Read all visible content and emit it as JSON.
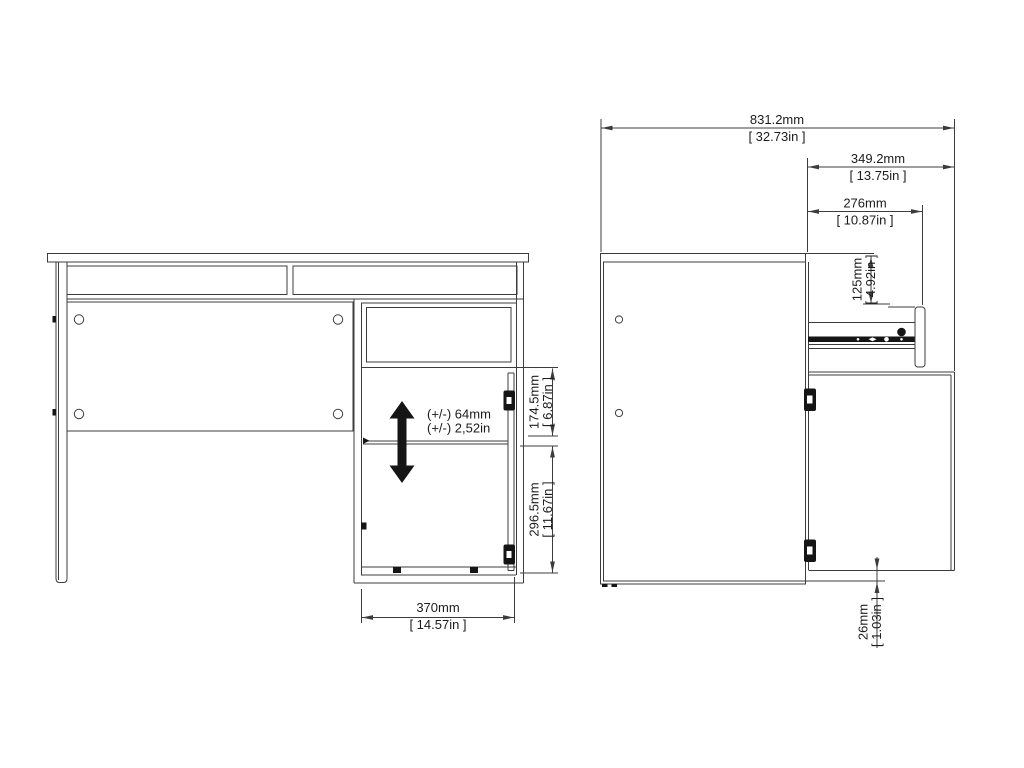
{
  "colors": {
    "background": "#ffffff",
    "line": "#3c3c3c",
    "text": "#1c1c1c",
    "solid_black": "#151515"
  },
  "dimensions": {
    "depth_total": {
      "mm": "831.2mm",
      "inch": "[ 32.73in ]"
    },
    "door_open_depth": {
      "mm": "349.2mm",
      "inch": "[ 13.75in ]"
    },
    "drawer_open_depth": {
      "mm": "276mm",
      "inch": "[ 10.87in ]"
    },
    "drawer_front_height": {
      "mm": "125mm",
      "inch": "[ 4.92in ]"
    },
    "upper_section_height": {
      "mm": "174.5mm",
      "inch": "[ 6.87in ]"
    },
    "lower_section_height": {
      "mm": "296.5mm",
      "inch": "[ 11.67in ]"
    },
    "cabinet_width": {
      "mm": "370mm",
      "inch": "[ 14.57in ]"
    },
    "door_bottom_clearance": {
      "mm": "26mm",
      "inch": "[ 1.03in ]"
    },
    "shelf_adjustment": {
      "metric": "(+/-) 64mm",
      "imperial": "(+/-) 2,52in"
    }
  }
}
